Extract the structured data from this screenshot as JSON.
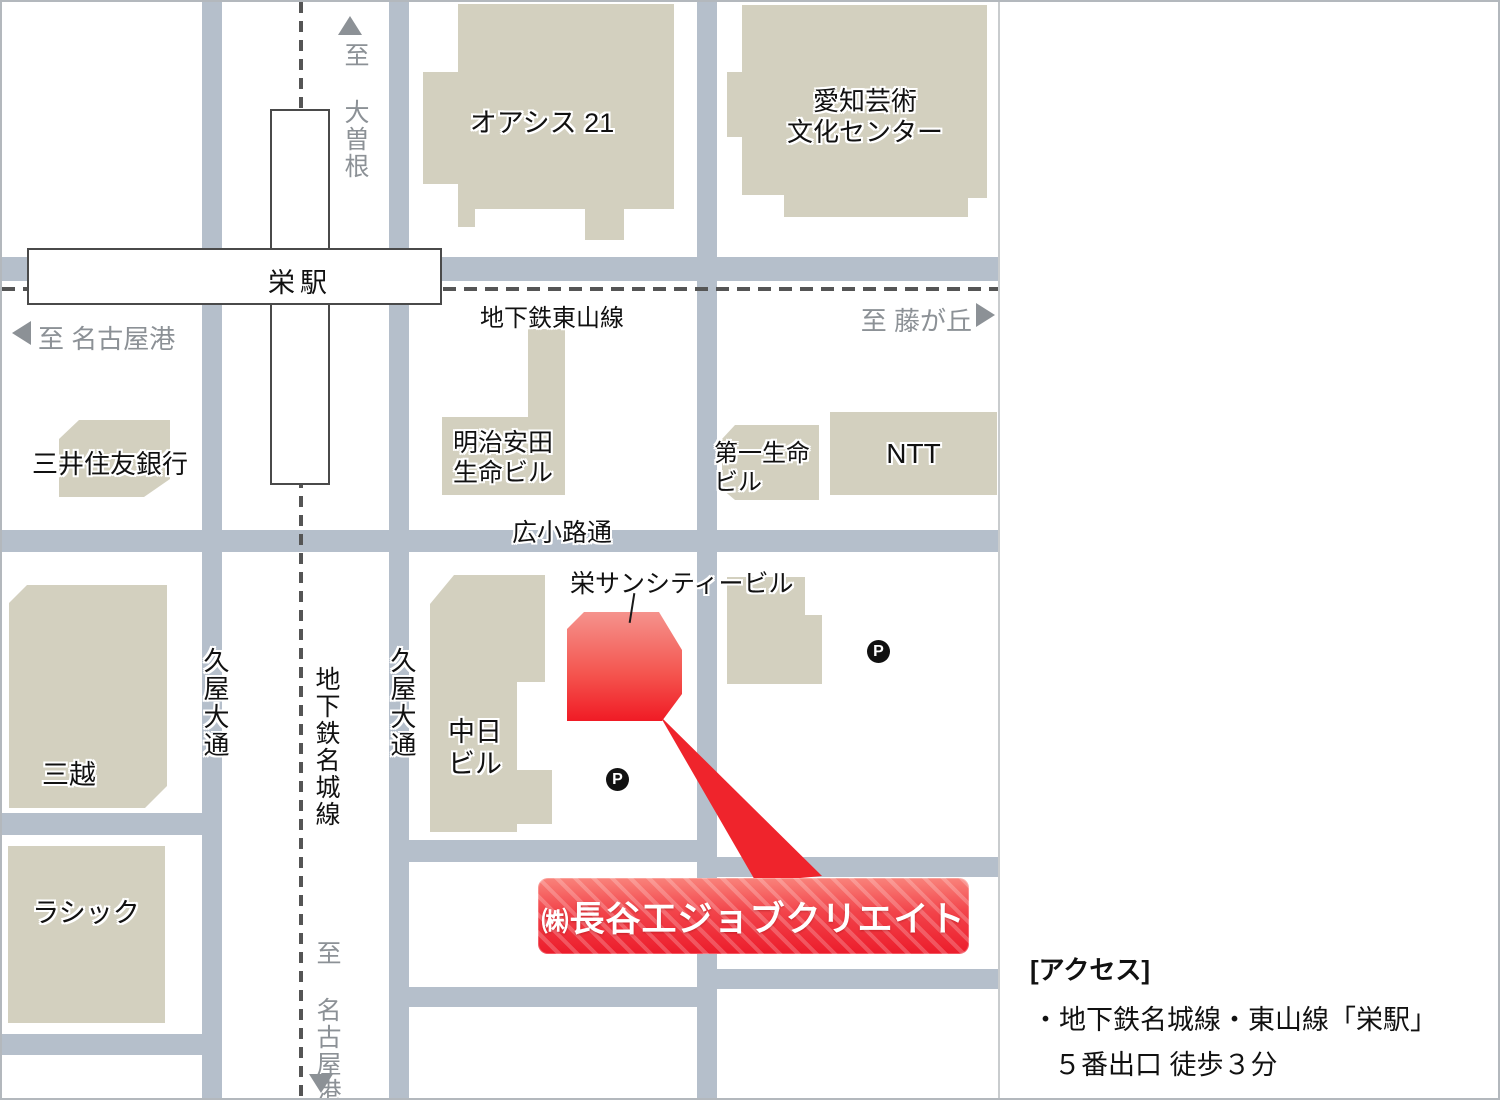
{
  "map": {
    "station": {
      "label": "栄駅"
    },
    "directions": {
      "north": "至 大曽根",
      "west": "至 名古屋港",
      "east": "至 藤が丘",
      "south": "至 名古屋港"
    },
    "subway_lines": {
      "higashiyama": "地下鉄東山線",
      "meijo": "地下鉄名城線"
    },
    "streets": {
      "hisaya_odori_west": "久屋大通",
      "hisaya_odori_east": "久屋大通",
      "hirokoji_dori": "広小路通"
    },
    "buildings": {
      "oasis21": "オアシス 21",
      "aichi_arts_line1": "愛知芸術",
      "aichi_arts_line2": "文化センター",
      "smbc": "三井住友銀行",
      "meiji_yasuda_line1": "明治安田",
      "meiji_yasuda_line2": "生命ビル",
      "daiichi_line1": "第一生命",
      "daiichi_line2": "ビル",
      "ntt": "NTT",
      "mitsukoshi": "三越",
      "lachic": "ラシック",
      "chunichi_line1": "中日",
      "chunichi_line2": "ビル",
      "sun_city": "栄サンシティービル"
    },
    "parking_icon": "P",
    "destination": {
      "prefix": "㈱",
      "name": "長谷工ジョブクリエイト"
    }
  },
  "access": {
    "heading": "[アクセス]",
    "line1": "・地下鉄名城線・東山線「栄駅」",
    "line2": "５番出口 徒歩３分"
  },
  "colors": {
    "road": "#b5bfcb",
    "building": "#d3d0bf",
    "accent_red": "#ee1c2b",
    "gray_text": "#8c9196",
    "dash_line": "#555555"
  }
}
